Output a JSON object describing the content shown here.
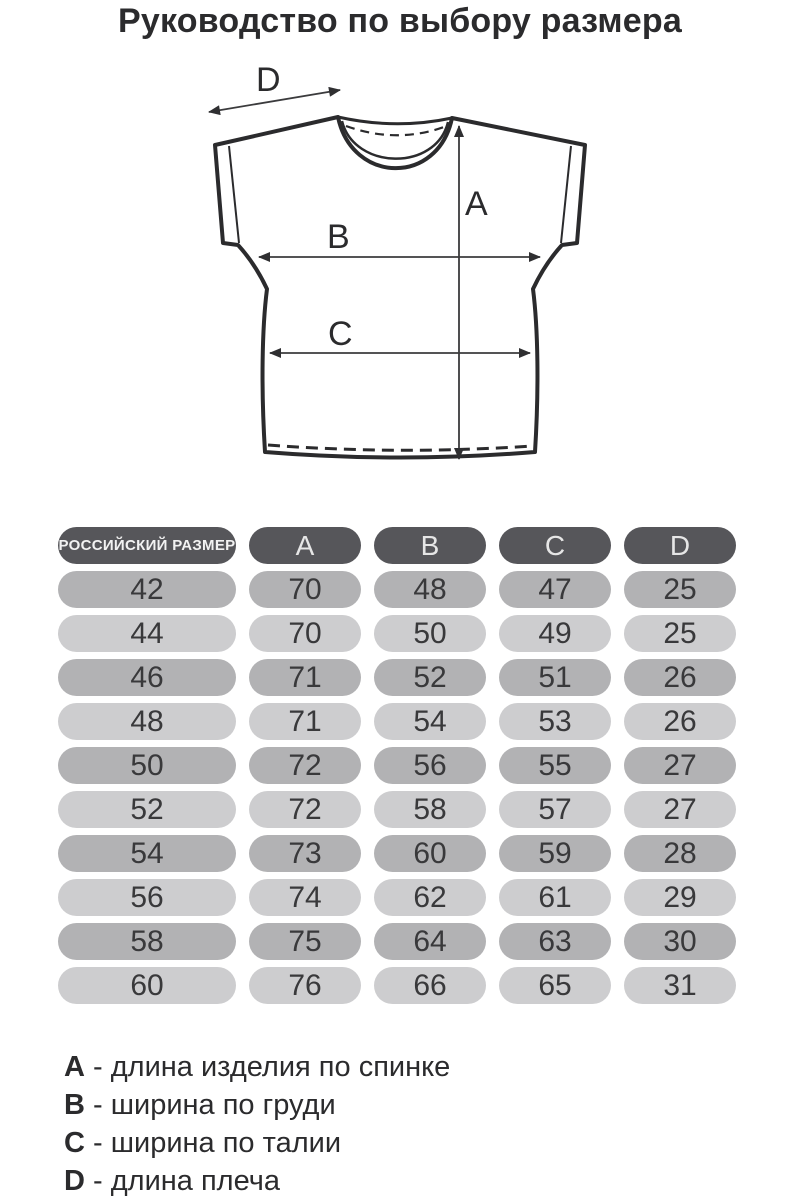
{
  "title": "Руководство по выбору размера",
  "diagram": {
    "labels": [
      "A",
      "B",
      "C",
      "D"
    ]
  },
  "table": {
    "size_header": "РОССИЙСКИЙ РАЗМЕР",
    "columns": [
      "A",
      "B",
      "C",
      "D"
    ],
    "rows": [
      {
        "size": "42",
        "values": [
          "70",
          "48",
          "47",
          "25"
        ]
      },
      {
        "size": "44",
        "values": [
          "70",
          "50",
          "49",
          "25"
        ]
      },
      {
        "size": "46",
        "values": [
          "71",
          "52",
          "51",
          "26"
        ]
      },
      {
        "size": "48",
        "values": [
          "71",
          "54",
          "53",
          "26"
        ]
      },
      {
        "size": "50",
        "values": [
          "72",
          "56",
          "55",
          "27"
        ]
      },
      {
        "size": "52",
        "values": [
          "72",
          "58",
          "57",
          "27"
        ]
      },
      {
        "size": "54",
        "values": [
          "73",
          "60",
          "59",
          "28"
        ]
      },
      {
        "size": "56",
        "values": [
          "74",
          "62",
          "61",
          "29"
        ]
      },
      {
        "size": "58",
        "values": [
          "75",
          "64",
          "63",
          "30"
        ]
      },
      {
        "size": "60",
        "values": [
          "76",
          "66",
          "65",
          "31"
        ]
      }
    ]
  },
  "legend": [
    {
      "key": "A",
      "desc": "- длина изделия по спинке"
    },
    {
      "key": "B",
      "desc": "- ширина по груди"
    },
    {
      "key": "C",
      "desc": "- ширина по талии"
    },
    {
      "key": "D",
      "desc": "- длина плеча"
    }
  ],
  "colors": {
    "header_pill": "#56565a",
    "header_text": "#e6e6e6",
    "row_dark": "#b2b2b4",
    "row_light": "#cdcdcf",
    "cell_text": "#39393b",
    "ink": "#2b2b2d"
  }
}
